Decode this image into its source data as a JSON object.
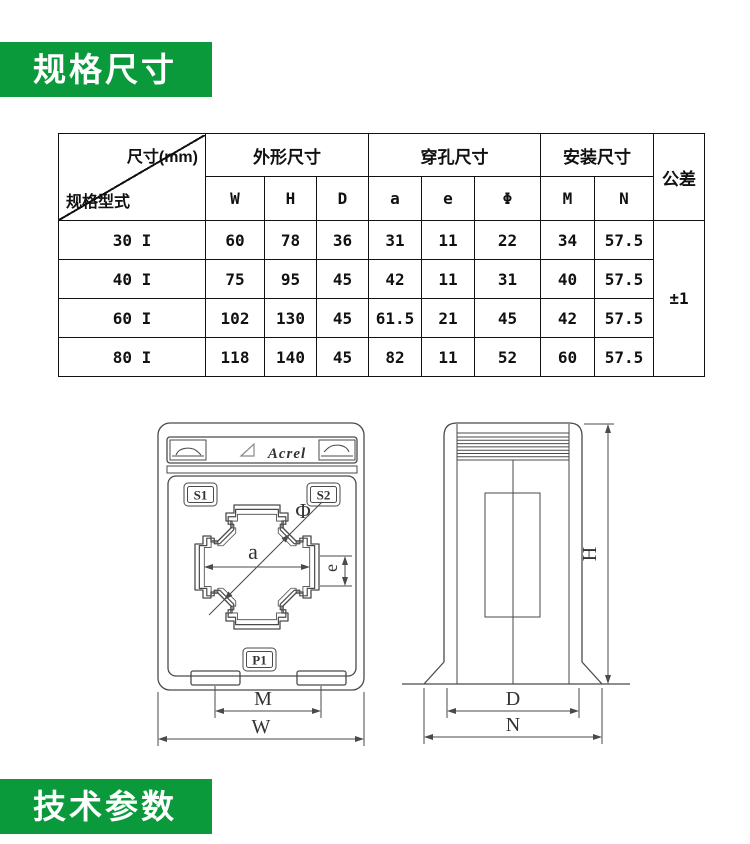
{
  "banners": {
    "spec_title": "规格尺寸",
    "tech_title": "技术参数",
    "green": "#0a9a3b"
  },
  "spec_table": {
    "corner": {
      "top_right": "尺寸(mm)",
      "bottom_left": "规格型式"
    },
    "groups": [
      {
        "label": "外形尺寸",
        "cols": [
          "W",
          "H",
          "D"
        ]
      },
      {
        "label": "穿孔尺寸",
        "cols": [
          "a",
          "e",
          "Φ"
        ]
      },
      {
        "label": "安装尺寸",
        "cols": [
          "M",
          "N"
        ]
      }
    ],
    "tolerance_header": "公差",
    "tolerance_value": "±1",
    "rows": [
      {
        "model": "30 I",
        "values": [
          "60",
          "78",
          "36",
          "31",
          "11",
          "22",
          "34",
          "57.5"
        ]
      },
      {
        "model": "40 I",
        "values": [
          "75",
          "95",
          "45",
          "42",
          "11",
          "31",
          "40",
          "57.5"
        ]
      },
      {
        "model": "60 I",
        "values": [
          "102",
          "130",
          "45",
          "61.5",
          "21",
          "45",
          "42",
          "57.5"
        ]
      },
      {
        "model": "80 I",
        "values": [
          "118",
          "140",
          "45",
          "82",
          "11",
          "52",
          "60",
          "57.5"
        ]
      }
    ]
  },
  "drawing": {
    "brand": "Acrel",
    "front": {
      "s1": "S1",
      "s2": "S2",
      "p1": "P1",
      "dim_a": "a",
      "dim_e": "e",
      "dim_phi": "Φ",
      "dim_m": "M",
      "dim_w": "W"
    },
    "side": {
      "dim_h": "H",
      "dim_d": "D",
      "dim_n": "N"
    }
  }
}
